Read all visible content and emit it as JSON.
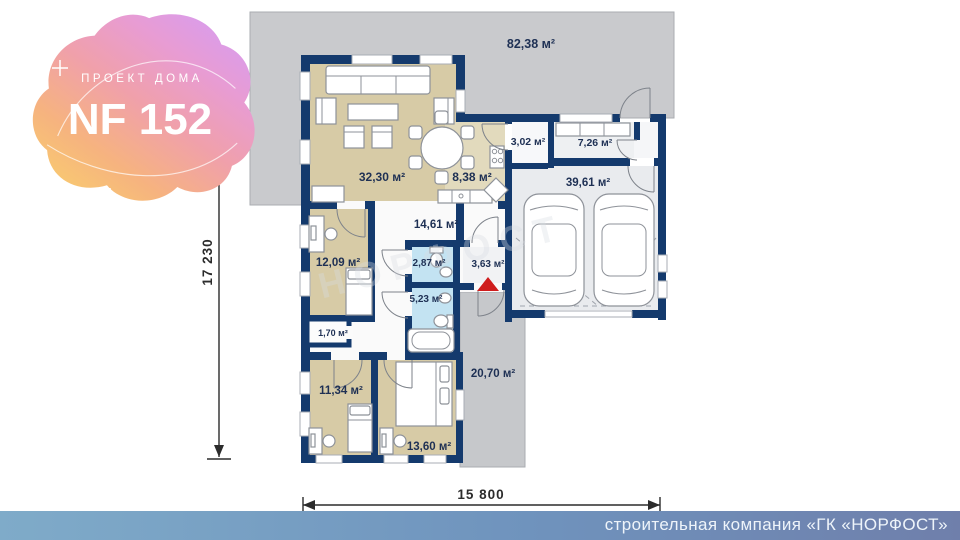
{
  "logo": {
    "subtitle": "ПРОЕКТ ДОМА",
    "title": "NF 152"
  },
  "rooms": {
    "terrace_top": "82,38 м²",
    "living": "32,30 м²",
    "kitchen": "8,38 м²",
    "pantry": "3,02 м²",
    "storage": "7,26 м²",
    "garage": "39,61 м²",
    "hall": "14,61 м²",
    "bedroom1": "12,09 м²",
    "bath_small": "2,87 м²",
    "entry": "3,63 м²",
    "bath_big": "5,23 м²",
    "closet": "1,70 м²",
    "bedroom2": "11,34 м²",
    "bedroom3": "13,60 м²",
    "terrace_side": "20,70 м²"
  },
  "dimensions": {
    "vertical": "17 230",
    "horizontal": "15 800"
  },
  "watermark": "НОРФОСТ",
  "footer": {
    "company": "строительная компания «ГК «НОРФОСТ»"
  },
  "colors": {
    "wall_navy": "#143a6d",
    "room_beige": "#d7cba6",
    "kitchen_beige": "#e2dabd",
    "bath_blue": "#c3e3f2",
    "terrace_gray": "#c9cacd",
    "garage_gray": "#e9ebee",
    "entrance_red": "#cf1d1d",
    "footer_left": "#7fabc9",
    "footer_right": "#6f7fab",
    "logo_yellow": "#fad46a",
    "logo_pink": "#f0a0ab",
    "logo_purple": "#d79df0"
  }
}
